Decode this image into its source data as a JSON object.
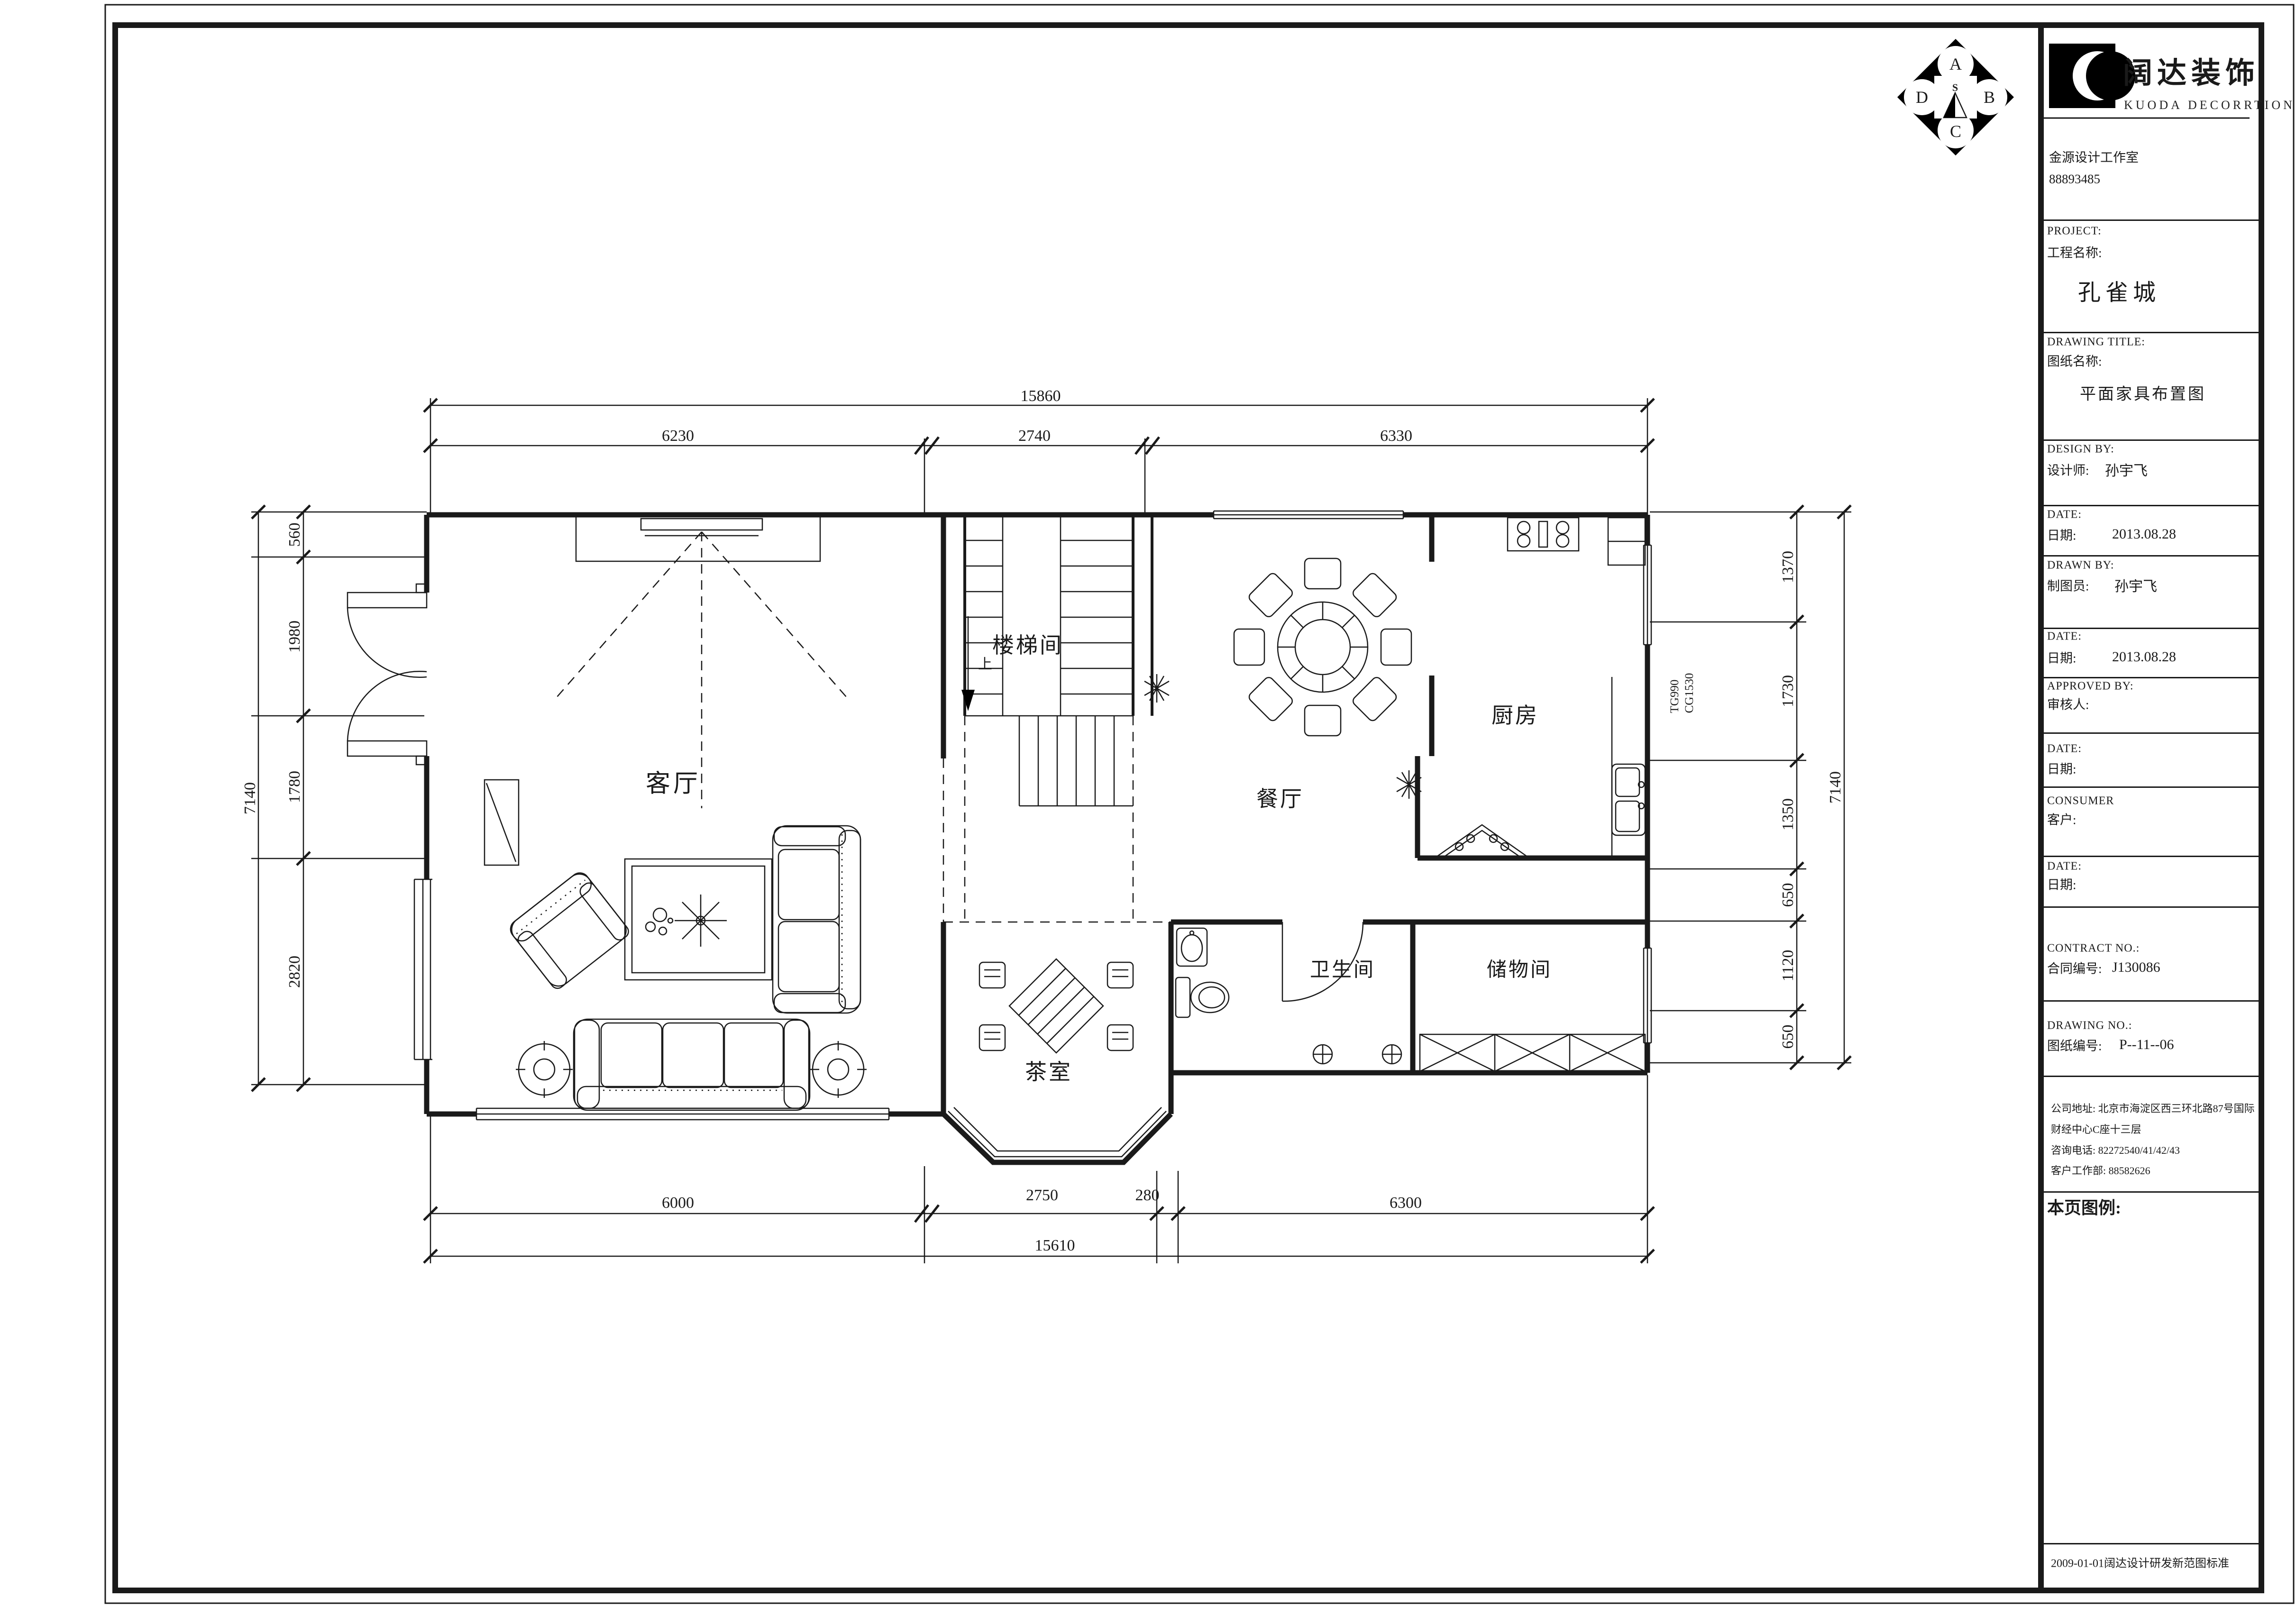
{
  "logo": {
    "brand_cn": "阔达装饰",
    "brand_en": "KUODA  DECORRTION",
    "studio_name": "金源设计工作室",
    "studio_phone": "88893485"
  },
  "compass": {
    "top": "A",
    "right": "B",
    "bottom": "C",
    "left": "D",
    "center": "S"
  },
  "title_block": {
    "project_en": "PROJECT:",
    "project_cn": "工程名称:",
    "project_name": "孔雀城",
    "drawing_title_en": "DRAWING TITLE:",
    "drawing_title_cn": "图纸名称:",
    "drawing_title": "平面家具布置图",
    "design_by_en": "DESIGN BY:",
    "design_by_cn": "设计师:",
    "designer": "孙宇飞",
    "date1_en": "DATE:",
    "date1_cn": "日期:",
    "date1": "2013.08.28",
    "drawn_by_en": "DRAWN BY:",
    "drawn_by_cn": "制图员:",
    "drafter": "孙宇飞",
    "date2_en": "DATE:",
    "date2_cn": "日期:",
    "date2": "2013.08.28",
    "approved_by_en": "APPROVED BY:",
    "approved_by_cn": "审核人:",
    "date3_en": "DATE:",
    "date3_cn": "日期:",
    "consumer_en": "CONSUMER",
    "consumer_cn": "客户:",
    "date4_en": "DATE:",
    "date4_cn": "日期:",
    "contract_en": "CONTRACT NO.:",
    "contract_cn": "合同编号:",
    "contract_no": "J130086",
    "drawing_no_en": "DRAWING NO.:",
    "drawing_no_cn": "图纸编号:",
    "drawing_no": "P--11--06",
    "address_line1": "公司地址: 北京市海淀区西三环北路87号国际",
    "address_line2": "财经中心C座十三层",
    "address_line3": "咨询电话: 82272540/41/42/43",
    "address_line4": "客户工作部: 88582626",
    "legend_label": "本页图例:",
    "footer_note": "2009-01-01阔达设计研发新范图标准"
  },
  "plan": {
    "rooms": {
      "living": "客厅",
      "stair": "楼梯间",
      "dining": "餐厅",
      "kitchen": "厨房",
      "bath": "卫生间",
      "storage": "储物间",
      "tea": "茶室"
    },
    "stair_up": "上",
    "wall_tag": {
      "line1": "TG990",
      "line2": "CG1530"
    },
    "dims": {
      "top": {
        "total": "15860",
        "segments": [
          "6230",
          "2740",
          "6330"
        ]
      },
      "bottom": {
        "total": "15610",
        "segments": [
          "6000",
          "2750",
          "280",
          "6300"
        ]
      },
      "left": {
        "total": "7140",
        "segments": [
          "560",
          "1980",
          "1780",
          "2820"
        ]
      },
      "right": {
        "total": "7140",
        "segments": [
          "1370",
          "1730",
          "1350",
          "650",
          "1120",
          "650"
        ]
      }
    }
  }
}
